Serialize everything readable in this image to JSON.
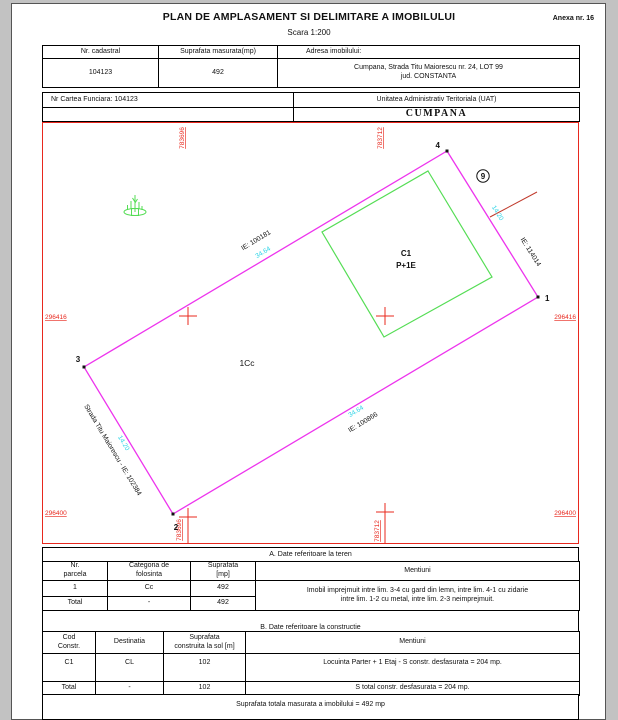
{
  "header": {
    "title": "PLAN DE AMPLASAMENT SI DELIMITARE A IMOBILULUI",
    "scale": "Scara 1:200",
    "annex": "Anexa nr. 16"
  },
  "info_table": {
    "col_cadastral": "Nr. cadastral",
    "col_area": "Suprafata masurata(mp)",
    "col_address": "Adresa imobilului:",
    "cadastral_no": "104123",
    "measured_area": "492",
    "address_line1": "Cumpana, Strada Titu Maiorescu nr. 24, LOT 99",
    "address_line2": "jud. CONSTANTA"
  },
  "land_book": {
    "label": "Nr Cartea Funciara: 104123",
    "uat_label": "Unitatea Administrativ Teritoriala (UAT)",
    "uat_name": "CUMPANA"
  },
  "plan": {
    "vertex_1": "1",
    "vertex_2": "2",
    "vertex_3": "3",
    "vertex_4": "4",
    "neighbor_parcel": "9",
    "parcel_label": "1Cc",
    "building_code": "C1",
    "building_floors": "P+1E",
    "street_label": "Strada Titu Maiorescu - IE: 102384",
    "ie_north": "IE: 100181",
    "ie_south": "IE: 100866",
    "ie_east": "IE: 114014",
    "dim_north": "34.64",
    "dim_south": "34.64",
    "dim_east": "14.20",
    "dim_west": "14.20",
    "coord_top_left": "783696",
    "coord_top_right": "783712",
    "coord_bottom_left": "783696",
    "coord_bottom_right": "783712",
    "coord_left_top": "296416",
    "coord_left_bottom": "296400",
    "coord_right_top": "296416",
    "coord_right_bottom": "296400",
    "colors": {
      "boundary": "#ed34ed",
      "building": "#55dd55",
      "grid": "#e8281e",
      "dimension": "#27d3e6"
    }
  },
  "section_a": {
    "title": "A. Date referitoare la teren",
    "headers": {
      "parcel_l1": "Nr.",
      "parcel_l2": "parcela",
      "category_l1": "Categoria de",
      "category_l2": "folosinta",
      "area_l1": "Suprafata",
      "area_l2": "[mp]",
      "mentions": "Mentiuni"
    },
    "rows": [
      {
        "no": "1",
        "category": "Cc",
        "area": "492"
      },
      {
        "no": "Total",
        "category": "-",
        "area": "492"
      }
    ],
    "mentions_l1": "Imobil imprejmuit intre lim. 3-4 cu gard din lemn, intre lim. 4-1 cu zidarie",
    "mentions_l2": "intre lim. 1-2 cu metal, intre lim. 2-3 neimprejmuit."
  },
  "section_b": {
    "title": "B. Date referitoare la constructie",
    "headers": {
      "code_l1": "Cod",
      "code_l2": "Constr.",
      "destination": "Destinatia",
      "area_l1": "Suprafata",
      "area_l2": "construita la sol [m]",
      "mentions": "Mentiuni"
    },
    "rows": [
      {
        "code": "C1",
        "destination": "CL",
        "area": "102",
        "mentions": "Locuinta Parter + 1 Etaj  - S constr. desfasurata = 204 mp."
      },
      {
        "code": "Total",
        "destination": "-",
        "area": "102",
        "mentions": "S total constr. desfasurata = 204 mp."
      }
    ],
    "total_note": "Suprafata totala masurata a imobilului = 492 mp"
  }
}
